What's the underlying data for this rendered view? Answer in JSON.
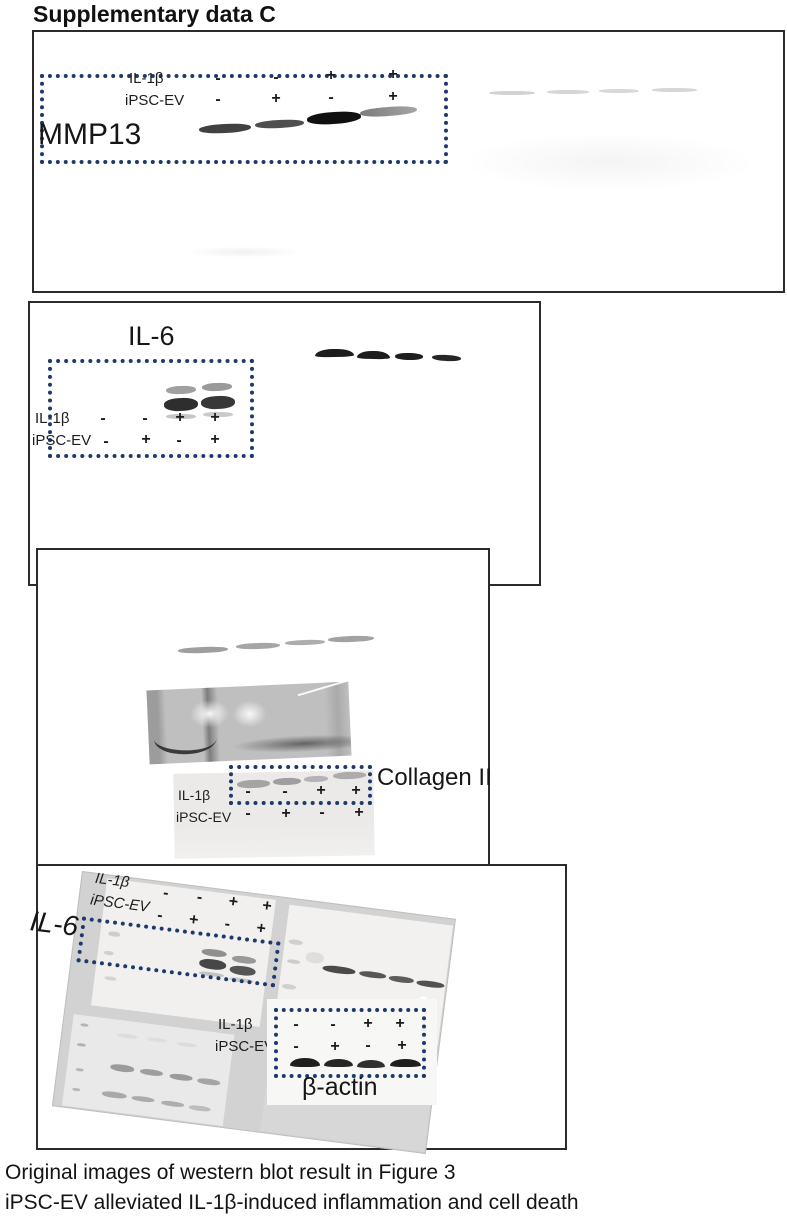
{
  "title": "Supplementary data C",
  "accent_color": "#1e3a6d",
  "caption": {
    "line1": "Original images of western blot result in Figure 3",
    "line2": "iPSC-EV alleviated IL-1β-induced inflammation and cell death"
  },
  "panels": {
    "mmp13": {
      "label": "MMP13",
      "row1_label": "IL-1β",
      "row2_label": "iPSC-EV",
      "row1": [
        "-",
        "-",
        "+",
        "+"
      ],
      "row2": [
        "-",
        "+",
        "-",
        "+"
      ]
    },
    "il6": {
      "label": "IL-6",
      "row1_label": "IL-1β",
      "row2_label": "iPSC-EV",
      "row1": [
        "-",
        "-",
        "+",
        "+"
      ],
      "row2": [
        "-",
        "+",
        "-",
        "+"
      ]
    },
    "collagen2": {
      "label": "Collagen II",
      "row1_label": "IL-1β",
      "row2_label": "iPSC-EV",
      "row1": [
        "-",
        "-",
        "+",
        "+"
      ],
      "row2": [
        "-",
        "+",
        "-",
        "+"
      ]
    },
    "composite": {
      "il6_label": "IL-6",
      "bactin_label": "β-actin",
      "top_row1_label": "IL-1β",
      "top_row2_label": "iPSC-EV",
      "top_row1": [
        "-",
        "-",
        "+",
        "+"
      ],
      "top_row2": [
        "-",
        "+",
        "-",
        "+"
      ],
      "bactin_row1_label": "IL-1β",
      "bactin_row2_label": "iPSC-EV",
      "bactin_row1": [
        "-",
        "-",
        "+",
        "+"
      ],
      "bactin_row2": [
        "-",
        "+",
        "-",
        "+"
      ]
    }
  }
}
